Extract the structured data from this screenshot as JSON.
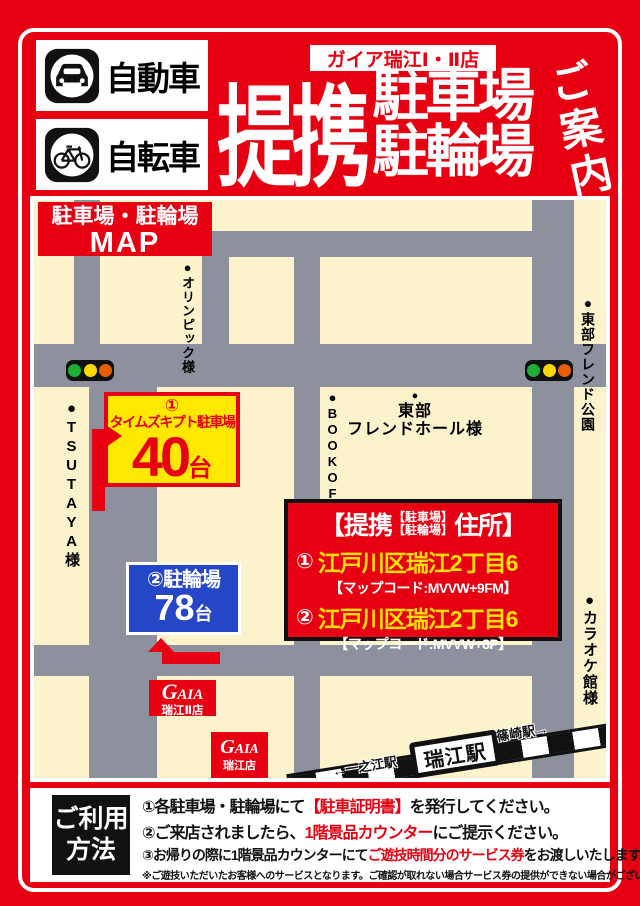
{
  "colors": {
    "red": "#e60012",
    "cream": "#fcf3cc",
    "road_gray": "#8d919e",
    "parking_yellow": "#ffe800",
    "bicycle_blue": "#2646c8",
    "address_yellow": "#ffe100",
    "signal_green": "#1fae35",
    "signal_yellow": "#ffd900",
    "signal_orange": "#e66000"
  },
  "header": {
    "vehicle_car": "自動車",
    "vehicle_bicycle": "自転車",
    "store_badge": "ガイア瑞江Ⅰ・Ⅱ店",
    "title_main": "提携",
    "title_line1": "駐車場",
    "title_line2": "駐輪場",
    "title_suffix": "ご案内"
  },
  "map": {
    "title_line1": "駐車場・駐輪場",
    "title_line2": "MAP",
    "landmarks": {
      "tsutaya": "●TSUTAYA様",
      "olympic": "●オリンピック様",
      "bookoff": "●BOOKOFF様",
      "tobu_hall_dot": "●",
      "tobu_hall_line1": "東部",
      "tobu_hall_line2": "フレンドホール様",
      "tobu_park": "●東部フレンド公園",
      "karaoke": "●カラオケ館様"
    },
    "parking_box": {
      "number": "①",
      "name": "タイムズキプト駐車場",
      "capacity": "40",
      "unit": "台"
    },
    "bicycle_box": {
      "line1": "②駐輪場",
      "capacity": "78",
      "unit": "台"
    },
    "address_box": {
      "header_pre": "【提携",
      "header_small1": "【駐車場】",
      "header_small2": "【駐輪場】",
      "header_post": "住所】",
      "item1_num": "①",
      "item1_address": "江戸川区瑞江2丁目6",
      "item1_mapcode": "【マップコード:MVVW+9FM】",
      "item2_num": "②",
      "item2_address": "江戸川区瑞江2丁目6",
      "item2_mapcode": "【マップコード:MVVW+8P】"
    },
    "gaia_store1": {
      "logo_g": "G",
      "logo_rest": "AIA",
      "name": "瑞江Ⅱ店"
    },
    "gaia_store2": {
      "logo_g": "G",
      "logo_rest": "AIA",
      "name": "瑞江店"
    },
    "station": {
      "name": "瑞江駅",
      "left_label": "←一之江駅",
      "right_label": "篠崎駅→"
    }
  },
  "instructions": {
    "method_title_line1": "ご利用",
    "method_title_line2": "方法",
    "steps": [
      {
        "pre": "①各駐車場・駐輪場にて",
        "em": "【駐車証明書】",
        "post": "を発行してください。"
      },
      {
        "pre": "②ご来店されましたら、",
        "em": "1階景品カウンター",
        "post": "にご提示ください。"
      },
      {
        "pre": "③お帰りの際に1階景品カウンターにて",
        "em": "ご遊技時間分のサービス券",
        "post": "をお渡しいたします。"
      }
    ],
    "note": "※ご遊技いただいたお客様へのサービスとなります。ご確認が取れない場合サービス券の提供ができない場合がございます。"
  }
}
